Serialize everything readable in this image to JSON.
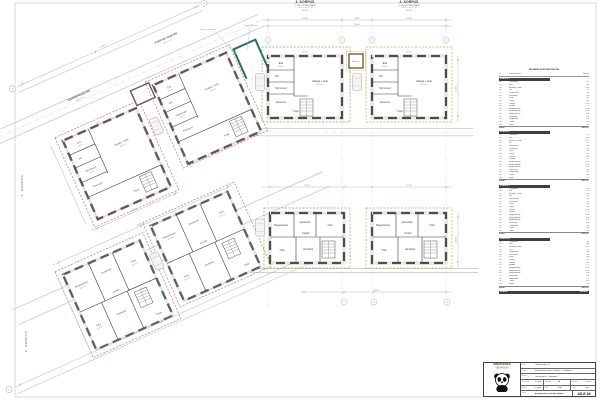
{
  "colors": {
    "accent_green": "#7ab648",
    "accent_orange": "#e2a23c",
    "accent_pink": "#c4756b",
    "accent_teal": "#2a6e68",
    "wall_dark": "#4d4d4d",
    "dim_gray": "#9a9a9a"
  },
  "side_labels": [
    {
      "text": "1. KORPUS"
    },
    {
      "text": "2. KORPUS"
    }
  ],
  "plan_titles": [
    {
      "name": "3. KORPUS",
      "sub": "1. ja 2. korruse plaan",
      "note": "±0.00 = abs 21.50",
      "scale": "M 1:50"
    },
    {
      "name": "4. KORPUS",
      "sub": "1. ja 2. korruse plaan",
      "note": "±0.00 = abs 21.50",
      "scale": "M 1:50"
    }
  ],
  "road_labels": [
    {
      "line1": "KVARTALI SISETEE",
      "line2": "laius 5.5 m"
    },
    {
      "line1": "JUURDEPÄÄSUTEE",
      "line2": "laius 5.5 m"
    }
  ],
  "notes": [
    {
      "text": "Prügi- ja rattamaja"
    },
    {
      "text": "Olemasolev puu"
    }
  ],
  "shed_label": "Abihoone",
  "terrace_label": "Terass",
  "rooms_ground": [
    {
      "name": "Esik",
      "area": "8.6 m²"
    },
    {
      "name": "WC",
      "area": "2.1"
    },
    {
      "name": "Tehnoruum",
      "area": "5.8 m²"
    },
    {
      "name": "Pesuruum",
      "area": "4.9 m²"
    },
    {
      "name": "Elutuba + köök",
      "area": "29.4 m²"
    },
    {
      "name": "Trepp",
      "area": "6.3"
    }
  ],
  "rooms_upper": [
    {
      "name": "Magamistuba",
      "area": "14.8 m²"
    },
    {
      "name": "Garderoob",
      "area": "4.1"
    },
    {
      "name": "Tuba",
      "area": "12.6 m²"
    },
    {
      "name": "Koridor",
      "area": "7.2 m²"
    },
    {
      "name": "Tuba",
      "area": "11.9 m²"
    },
    {
      "name": "Vannituba",
      "area": "6.4"
    },
    {
      "name": "Trepp",
      "area": "6.3"
    }
  ],
  "dims": {
    "top1": "12750",
    "topgap": "2800",
    "top2": "12750",
    "top_total": "28300",
    "mid1": "12750",
    "mid2": "12750",
    "bottom_total": "14900",
    "right_top": "12450",
    "right_mid": "10150",
    "tl_total": "41250",
    "tl_sub": "16400",
    "bl_top": "18200",
    "bl_total": "43850"
  },
  "axes": {
    "top": [
      "1",
      "2",
      "3",
      "4"
    ],
    "bottom": [
      "2",
      "3",
      "4"
    ],
    "tl": [
      "A",
      "B"
    ],
    "bl": [
      "C",
      "D"
    ]
  },
  "table": {
    "title": "RUUMIDE EKSPLIKATSIOON",
    "columns": [
      "Nr",
      "Ruumi nimetus",
      "Pind m²"
    ],
    "sections": [
      {
        "header": "KORPUS 1",
        "total_label": "Kokku",
        "total": "146.8 m²",
        "rows": [
          [
            "101",
            "Tuulekoda",
            "4.2"
          ],
          [
            "102",
            "Esik",
            "8.6"
          ],
          [
            "103",
            "Elutuba + köök",
            "29.4"
          ],
          [
            "104",
            "WC",
            "2.1"
          ],
          [
            "105",
            "Tehnoruum",
            "5.8"
          ],
          [
            "106",
            "Pesuruum",
            "4.9"
          ],
          [
            "107",
            "Saun",
            "4.6"
          ],
          [
            "108",
            "Trepp",
            "6.3"
          ],
          [
            "109",
            "Terrass",
            "12.0"
          ],
          [
            "201",
            "Koridor",
            "7.2"
          ],
          [
            "202",
            "Magamistuba",
            "14.8"
          ],
          [
            "203",
            "Magamistuba",
            "12.6"
          ],
          [
            "204",
            "Magamistuba",
            "11.9"
          ],
          [
            "205",
            "Vannituba",
            "6.4"
          ],
          [
            "206",
            "Garderoob",
            "4.1"
          ],
          [
            "207",
            "Trepp",
            "6.3"
          ],
          [
            "208",
            "Rõdu",
            "5.6"
          ]
        ]
      },
      {
        "header": "KORPUS 2",
        "total_label": "Kokku",
        "total": "146.5 m²",
        "rows": [
          [
            "101",
            "Tuulekoda",
            "4.2"
          ],
          [
            "102",
            "Esik",
            "8.6"
          ],
          [
            "103",
            "Elutuba + köök",
            "28.7"
          ],
          [
            "104",
            "WC",
            "2.1"
          ],
          [
            "105",
            "Tehnoruum",
            "5.8"
          ],
          [
            "106",
            "Pesuruum",
            "4.9"
          ],
          [
            "107",
            "Saun",
            "4.6"
          ],
          [
            "108",
            "Trepp",
            "6.3"
          ],
          [
            "109",
            "Terrass",
            "12.0"
          ],
          [
            "201",
            "Koridor",
            "7.2"
          ],
          [
            "202",
            "Magamistuba",
            "15.2"
          ],
          [
            "203",
            "Magamistuba",
            "12.6"
          ],
          [
            "204",
            "Magamistuba",
            "11.9"
          ],
          [
            "205",
            "Vannituba",
            "6.4"
          ],
          [
            "206",
            "Garderoob",
            "4.1"
          ],
          [
            "207",
            "Trepp",
            "6.3"
          ],
          [
            "208",
            "Rõdu",
            "5.6"
          ]
        ]
      },
      {
        "header": "KORPUS 3",
        "total_label": "Kokku",
        "total": "146.8 m²",
        "rows": [
          [
            "101",
            "Tuulekoda",
            "4.2"
          ],
          [
            "102",
            "Esik",
            "8.6"
          ],
          [
            "103",
            "Elutuba + köök",
            "29.4"
          ],
          [
            "104",
            "WC",
            "2.1"
          ],
          [
            "105",
            "Tehnoruum",
            "5.8"
          ],
          [
            "106",
            "Pesuruum",
            "4.9"
          ],
          [
            "107",
            "Saun",
            "4.6"
          ],
          [
            "108",
            "Trepp",
            "6.3"
          ],
          [
            "109",
            "Terrass",
            "12.0"
          ],
          [
            "201",
            "Koridor",
            "7.2"
          ],
          [
            "202",
            "Magamistuba",
            "14.8"
          ],
          [
            "203",
            "Magamistuba",
            "12.6"
          ],
          [
            "204",
            "Magamistuba",
            "11.9"
          ],
          [
            "205",
            "Vannituba",
            "6.4"
          ],
          [
            "206",
            "Garderoob",
            "4.1"
          ],
          [
            "207",
            "Trepp",
            "6.3"
          ],
          [
            "208",
            "Rõdu",
            "5.6"
          ]
        ]
      },
      {
        "header": "KORPUS 4",
        "total_label": "Kokku",
        "total": "146.5 m²",
        "rows": [
          [
            "101",
            "Tuulekoda",
            "4.2"
          ],
          [
            "102",
            "Esik",
            "8.6"
          ],
          [
            "103",
            "Elutuba + köök",
            "28.7"
          ],
          [
            "104",
            "WC",
            "2.1"
          ],
          [
            "105",
            "Tehnoruum",
            "5.8"
          ],
          [
            "106",
            "Pesuruum",
            "4.9"
          ],
          [
            "107",
            "Saun",
            "4.6"
          ],
          [
            "108",
            "Trepp",
            "6.3"
          ],
          [
            "109",
            "Terrass",
            "12.0"
          ],
          [
            "201",
            "Koridor",
            "7.2"
          ],
          [
            "202",
            "Magamistuba",
            "15.2"
          ],
          [
            "203",
            "Magamistuba",
            "12.6"
          ],
          [
            "204",
            "Magamistuba",
            "11.9"
          ],
          [
            "205",
            "Vannituba",
            "6.4"
          ],
          [
            "206",
            "Garderoob",
            "4.1"
          ],
          [
            "207",
            "Trepp",
            "6.3"
          ],
          [
            "208",
            "Rõdu",
            "5.6"
          ]
        ]
      }
    ],
    "grand_total_label": "KOKKU",
    "grand_total": "586.6 m²"
  },
  "title_block": {
    "company_line1": "ARHIPANDA",
    "company_line2": "PROJEKT OÜ",
    "company_line3": "Reg nr 12345678",
    "rows": [
      {
        "label": "Tellija",
        "value": "Pandale Kodu OÜ"
      },
      {
        "label": "Projekt",
        "value": "Ridaelamute kvartal, 4 korpust — eelprojekt"
      },
      {
        "label": "Aadress",
        "value": "Pandakarja tn 7, Harjumaa"
      },
      {
        "label": "Projektijuht",
        "value": "M. Ilves"
      },
      {
        "label": "Arhitekt",
        "value": "U. Karu"
      },
      {
        "label": "Joonis",
        "value": "Asendiplaan ja korruste plaanid"
      }
    ],
    "stage_label": "Staadium",
    "stage": "EP",
    "date_label": "Kuupäev",
    "date": "11.2023",
    "scale_label": "Mõõt",
    "scale": "1:50",
    "worknr_label": "Töö nr",
    "worknr": "2318",
    "code": "AS-E-04"
  }
}
